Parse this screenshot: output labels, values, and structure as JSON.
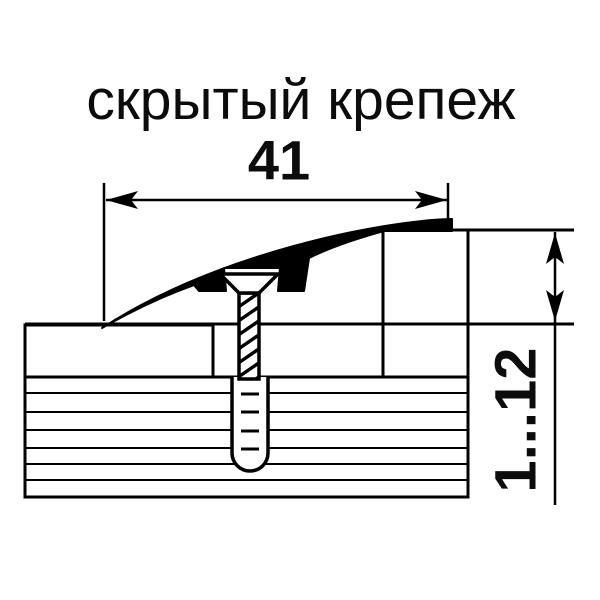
{
  "title": "скрытый крепеж",
  "dimensions": {
    "width_label": "41",
    "height_range_label": "1...12"
  },
  "colors": {
    "line": "#000000",
    "covering_fill": "#9a9a9a",
    "background": "#ffffff"
  },
  "parts": {
    "profile": "transition-profile-cross-section",
    "screw": "countersunk-screw",
    "anchor": "dowel-anchor-sleeve",
    "covering_left": "floor-covering-low-side",
    "covering_right": "floor-covering-high-side",
    "substrate": "subfloor-layered-base"
  }
}
